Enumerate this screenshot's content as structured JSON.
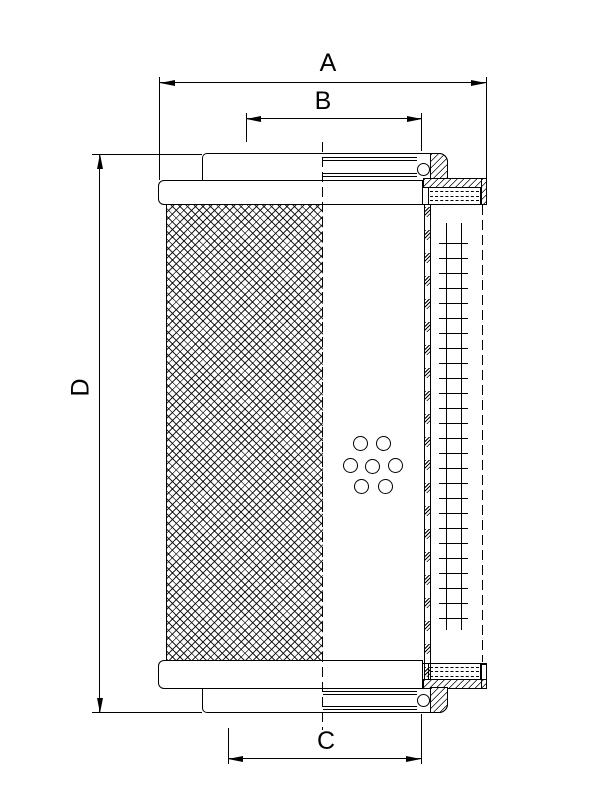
{
  "drawing": {
    "type": "technical-section-drawing",
    "subject": "hydraulic-filter-element",
    "dimension_labels": {
      "a": "A",
      "b": "B",
      "c": "C",
      "d": "D"
    },
    "line_color": "#000000",
    "background_color": "#ffffff"
  }
}
